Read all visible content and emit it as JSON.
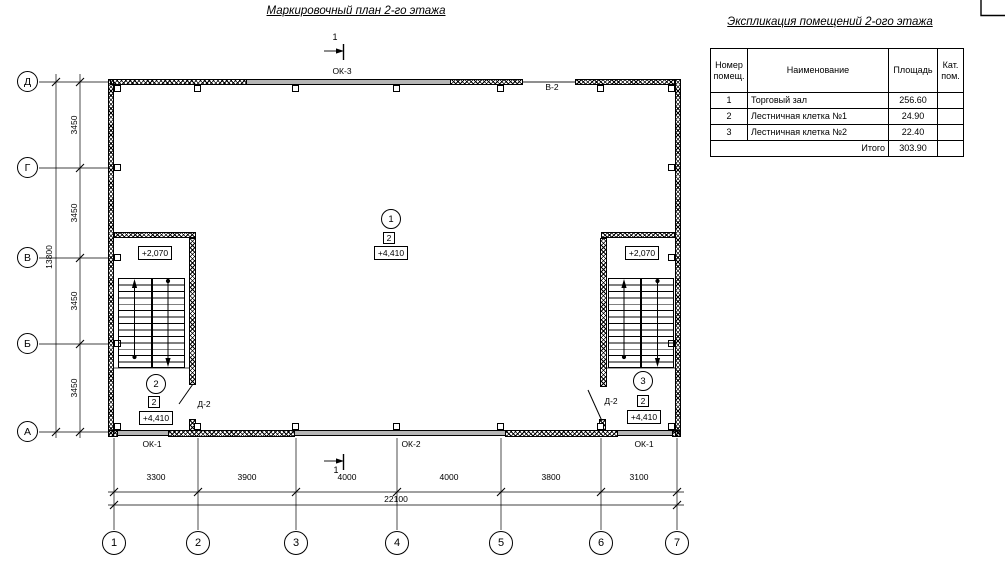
{
  "titles": {
    "plan": "Маркировочный план 2-го этажа",
    "explication": "Экспликация помещений 2-ого этажа"
  },
  "explication": {
    "headers": {
      "number": "Номер помещ.",
      "name": "Наименование",
      "area": "Площадь",
      "category": "Кат. пом."
    },
    "rows": [
      {
        "number": "1",
        "name": "Торговый зал",
        "area": "256.60",
        "category": ""
      },
      {
        "number": "2",
        "name": "Лестничная клетка №1",
        "area": "24.90",
        "category": ""
      },
      {
        "number": "3",
        "name": "Лестничная клетка №2",
        "area": "22.40",
        "category": ""
      }
    ],
    "total": {
      "label": "Итого",
      "area": "303.90",
      "category": ""
    }
  },
  "axes": {
    "vertical": [
      "Д",
      "Г",
      "В",
      "Б",
      "А"
    ],
    "horizontal": [
      "1",
      "2",
      "3",
      "4",
      "5",
      "6",
      "7"
    ]
  },
  "dimensions": {
    "vertical_segments": [
      "3450",
      "3450",
      "3450",
      "3450"
    ],
    "vertical_total": "13800",
    "horizontal_segments": [
      "3300",
      "3900",
      "4000",
      "4000",
      "3800",
      "3100"
    ],
    "horizontal_total": "22100"
  },
  "labels": {
    "window_top": "ОК-3",
    "opening_top": "В-2",
    "window_bottom_left": "ОК-1",
    "window_bottom_center": "ОК-2",
    "window_bottom_right": "ОК-1",
    "door": "Д-2",
    "section_mark": "1"
  },
  "levels": {
    "stair_landing": "+2,070",
    "floor": "+4,410"
  },
  "markers": {
    "hall": "1",
    "stair1": "2",
    "stair2": "3",
    "floor_type": "2"
  },
  "colors": {
    "line": "#000000",
    "window_fill": "#b5b5b5"
  }
}
